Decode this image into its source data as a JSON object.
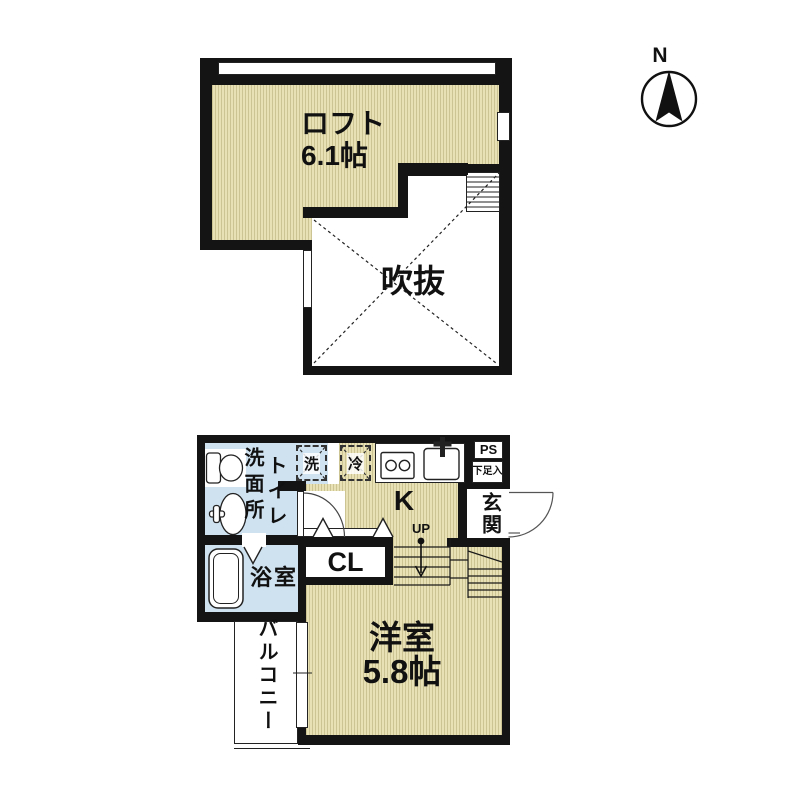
{
  "title": "1K loft apartment floor plan",
  "compass": {
    "north_label": "N"
  },
  "colors": {
    "wall": "#141414",
    "tatami_base": "#e8e1b5",
    "tatami_stripe": "#cdc493",
    "wet_area_blue": "#cfe2f0",
    "line": "#222222"
  },
  "upper_floor": {
    "loft_label": "ロフト",
    "loft_size": "6.1帖",
    "void_label": "吹抜"
  },
  "lower_floor": {
    "toilet_label": "トイレ",
    "washroom_label": "洗面所",
    "washer_label": "洗",
    "fridge_label": "冷",
    "kitchen_label": "K",
    "ps_label": "PS",
    "shoe_cabinet_label": "下足入",
    "entrance_label": "玄関",
    "up_label": "UP",
    "closet_label": "CL",
    "bathroom_label": "浴室",
    "balcony_label": "バルコニー",
    "room_label": "洋室",
    "room_size": "5.8帖"
  }
}
